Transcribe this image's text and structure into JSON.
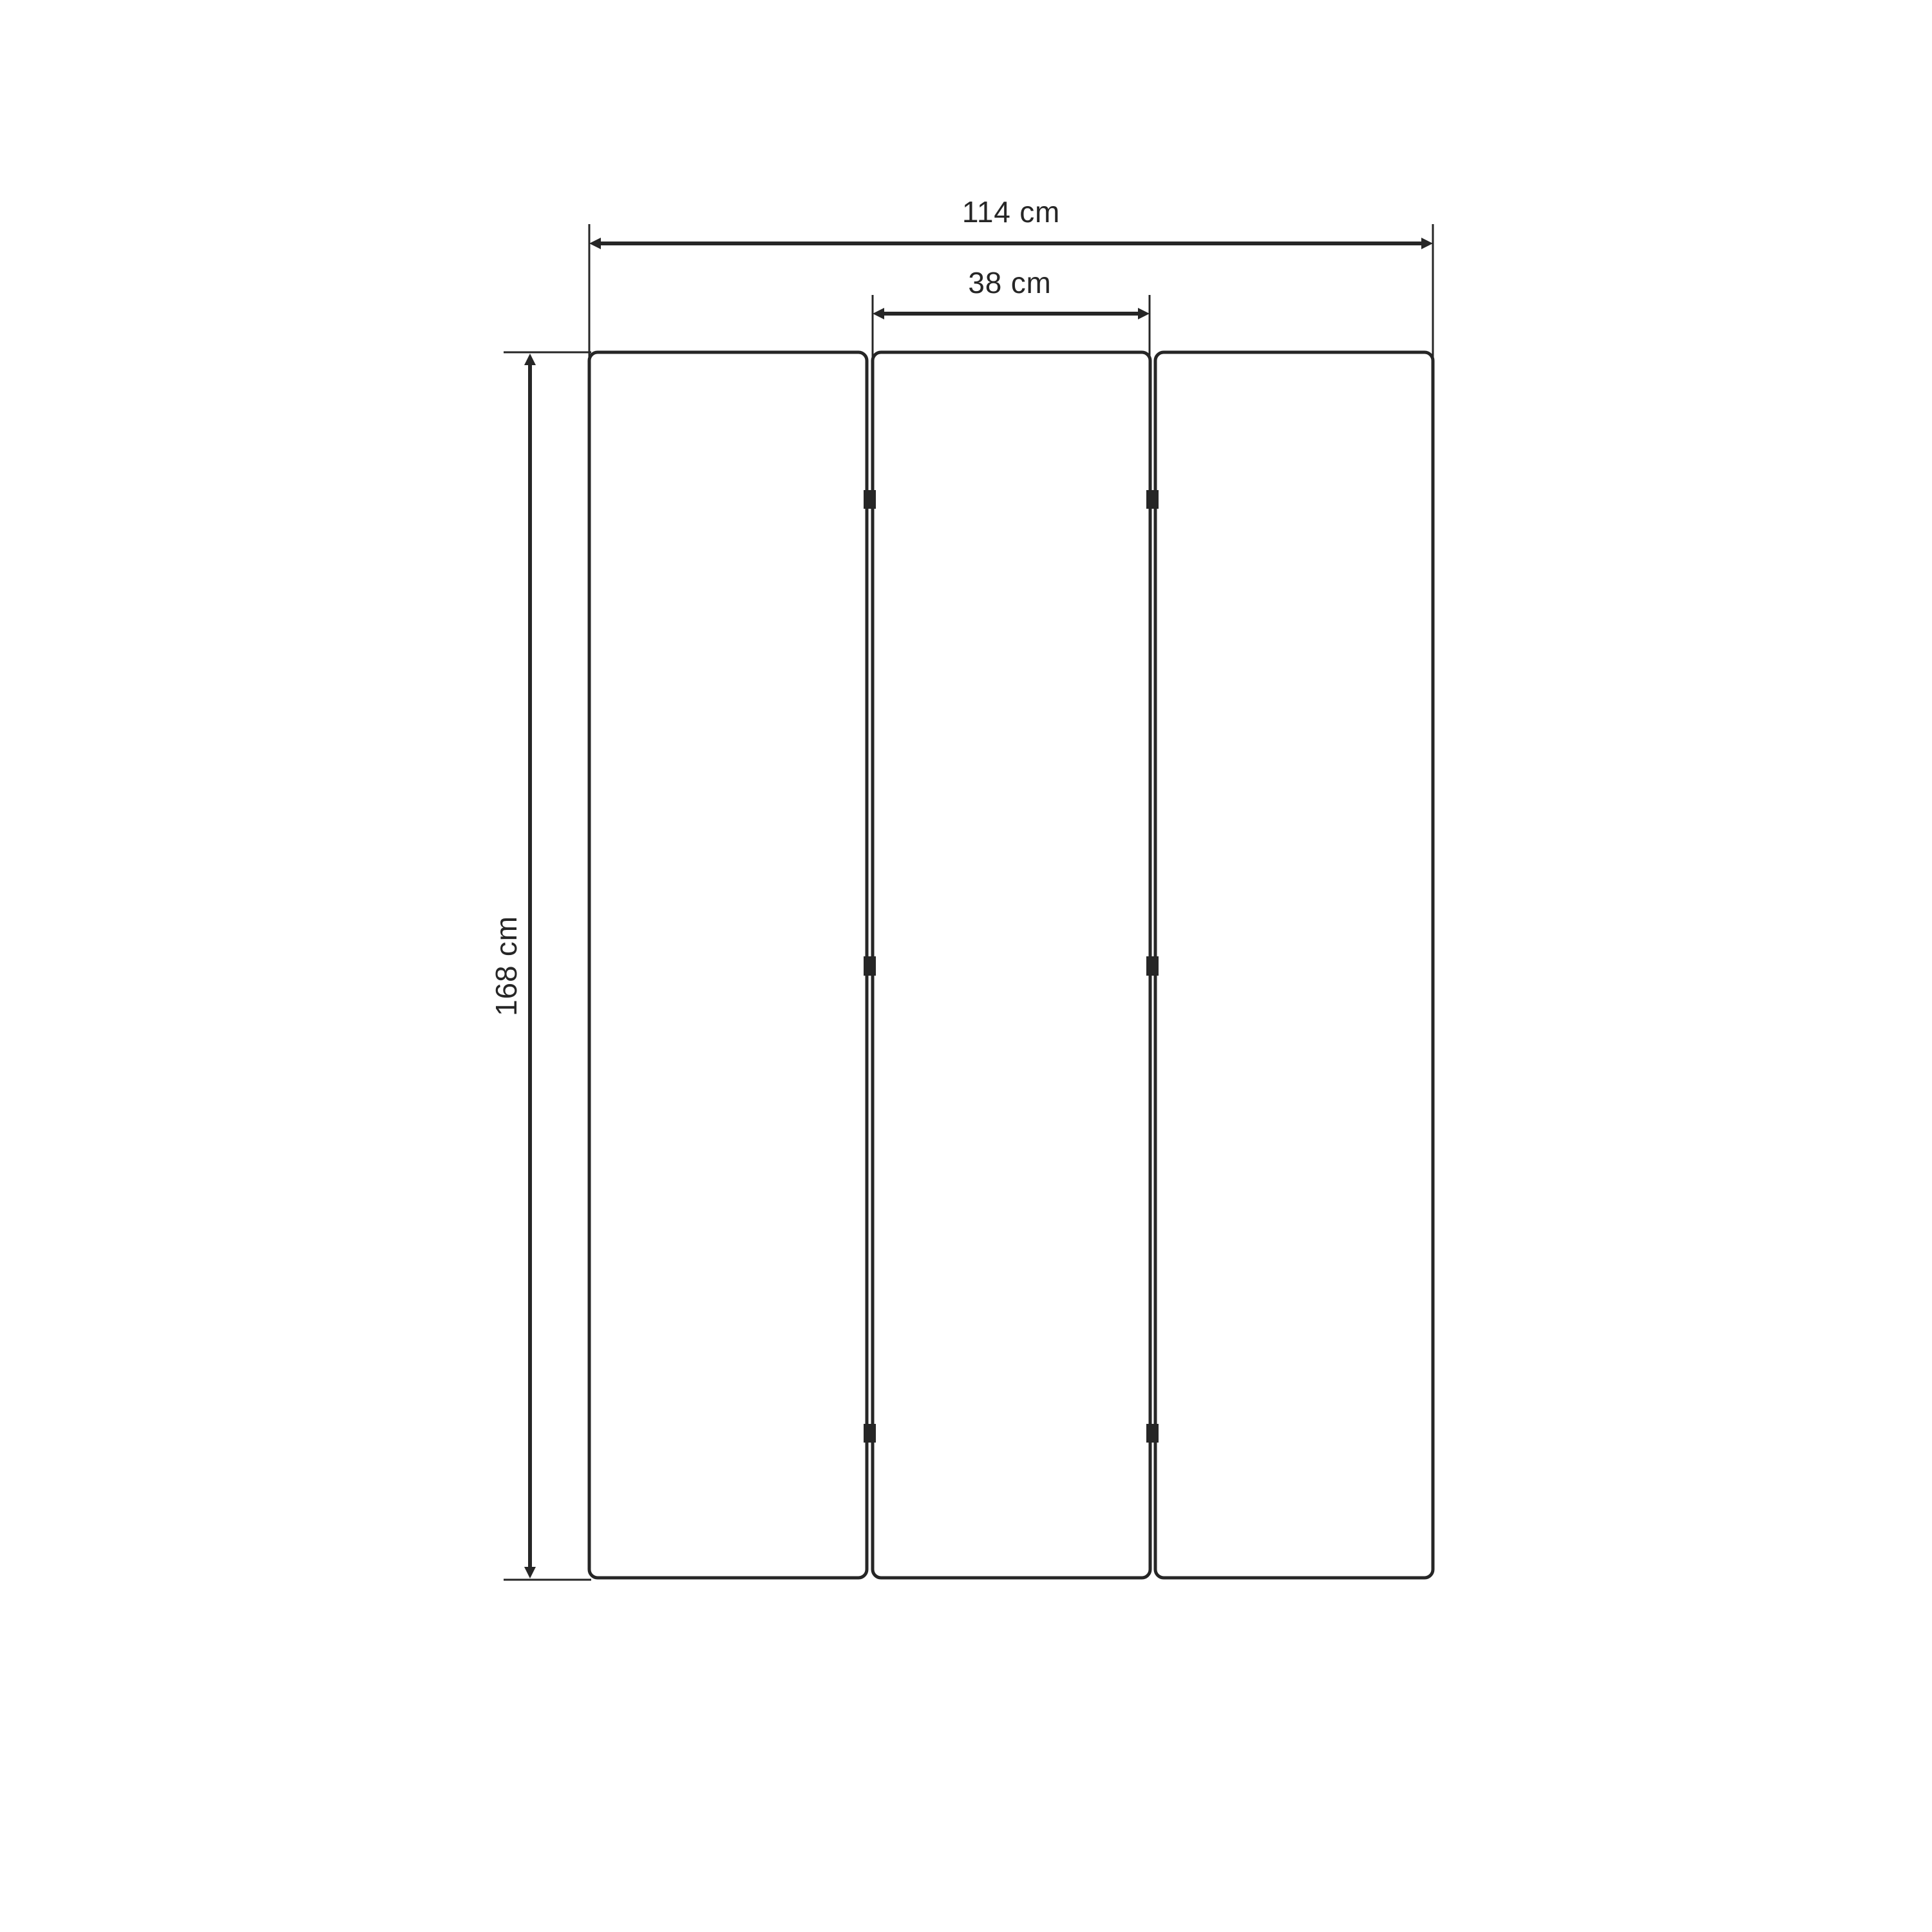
{
  "page": {
    "background_color": "#ffffff"
  },
  "drawing": {
    "line_color": "#262626",
    "panel_fill": "#ffffff",
    "panel_count": 3,
    "hinge_rows": 3,
    "dimensions": {
      "total_width": {
        "label": "114 cm",
        "value": 114,
        "unit": "cm"
      },
      "panel_width": {
        "label": "38 cm",
        "value": 38,
        "unit": "cm"
      },
      "height": {
        "label": "168 cm",
        "value": 168,
        "unit": "cm"
      }
    }
  }
}
